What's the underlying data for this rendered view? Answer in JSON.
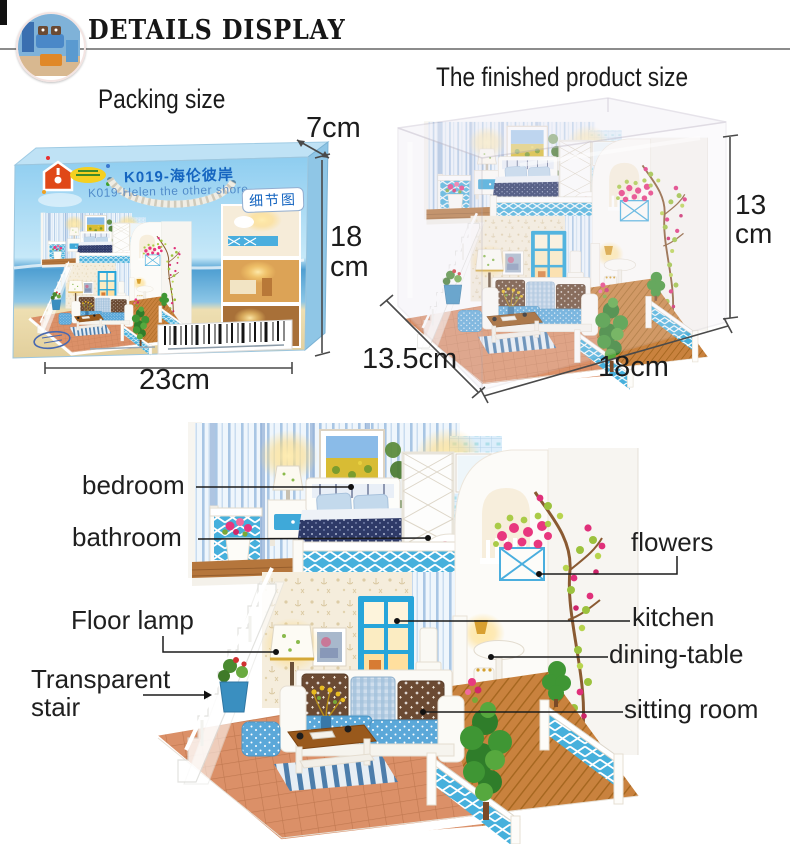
{
  "header": {
    "title": "DETAILS DISPLAY"
  },
  "packing": {
    "heading": "Packing size",
    "box": {
      "title_cn": "K019-海伦彼岸",
      "title_en": "K019-Helen the other shore",
      "corner_badge": "细节图"
    },
    "dimensions": {
      "width": "23cm",
      "height": "18 cm",
      "depth": "7cm"
    }
  },
  "finished_product": {
    "heading": "The finished product size",
    "dimensions": {
      "width": "18cm",
      "height": "13 cm",
      "depth": "13.5cm"
    }
  },
  "callouts": {
    "bedroom": "bedroom",
    "bathroom": "bathroom",
    "floor_lamp": "Floor lamp",
    "transparent_stair": "Transparent stair",
    "flowers": "flowers",
    "kitchen": "kitchen",
    "dining_table": "dining-table",
    "sitting_room": "sitting room"
  },
  "colors": {
    "accent_blue": "#3fa9d9",
    "label_text": "#1a1a1a",
    "box_title_blue": "#1565c0",
    "divider_gray": "#8c8c8c"
  }
}
